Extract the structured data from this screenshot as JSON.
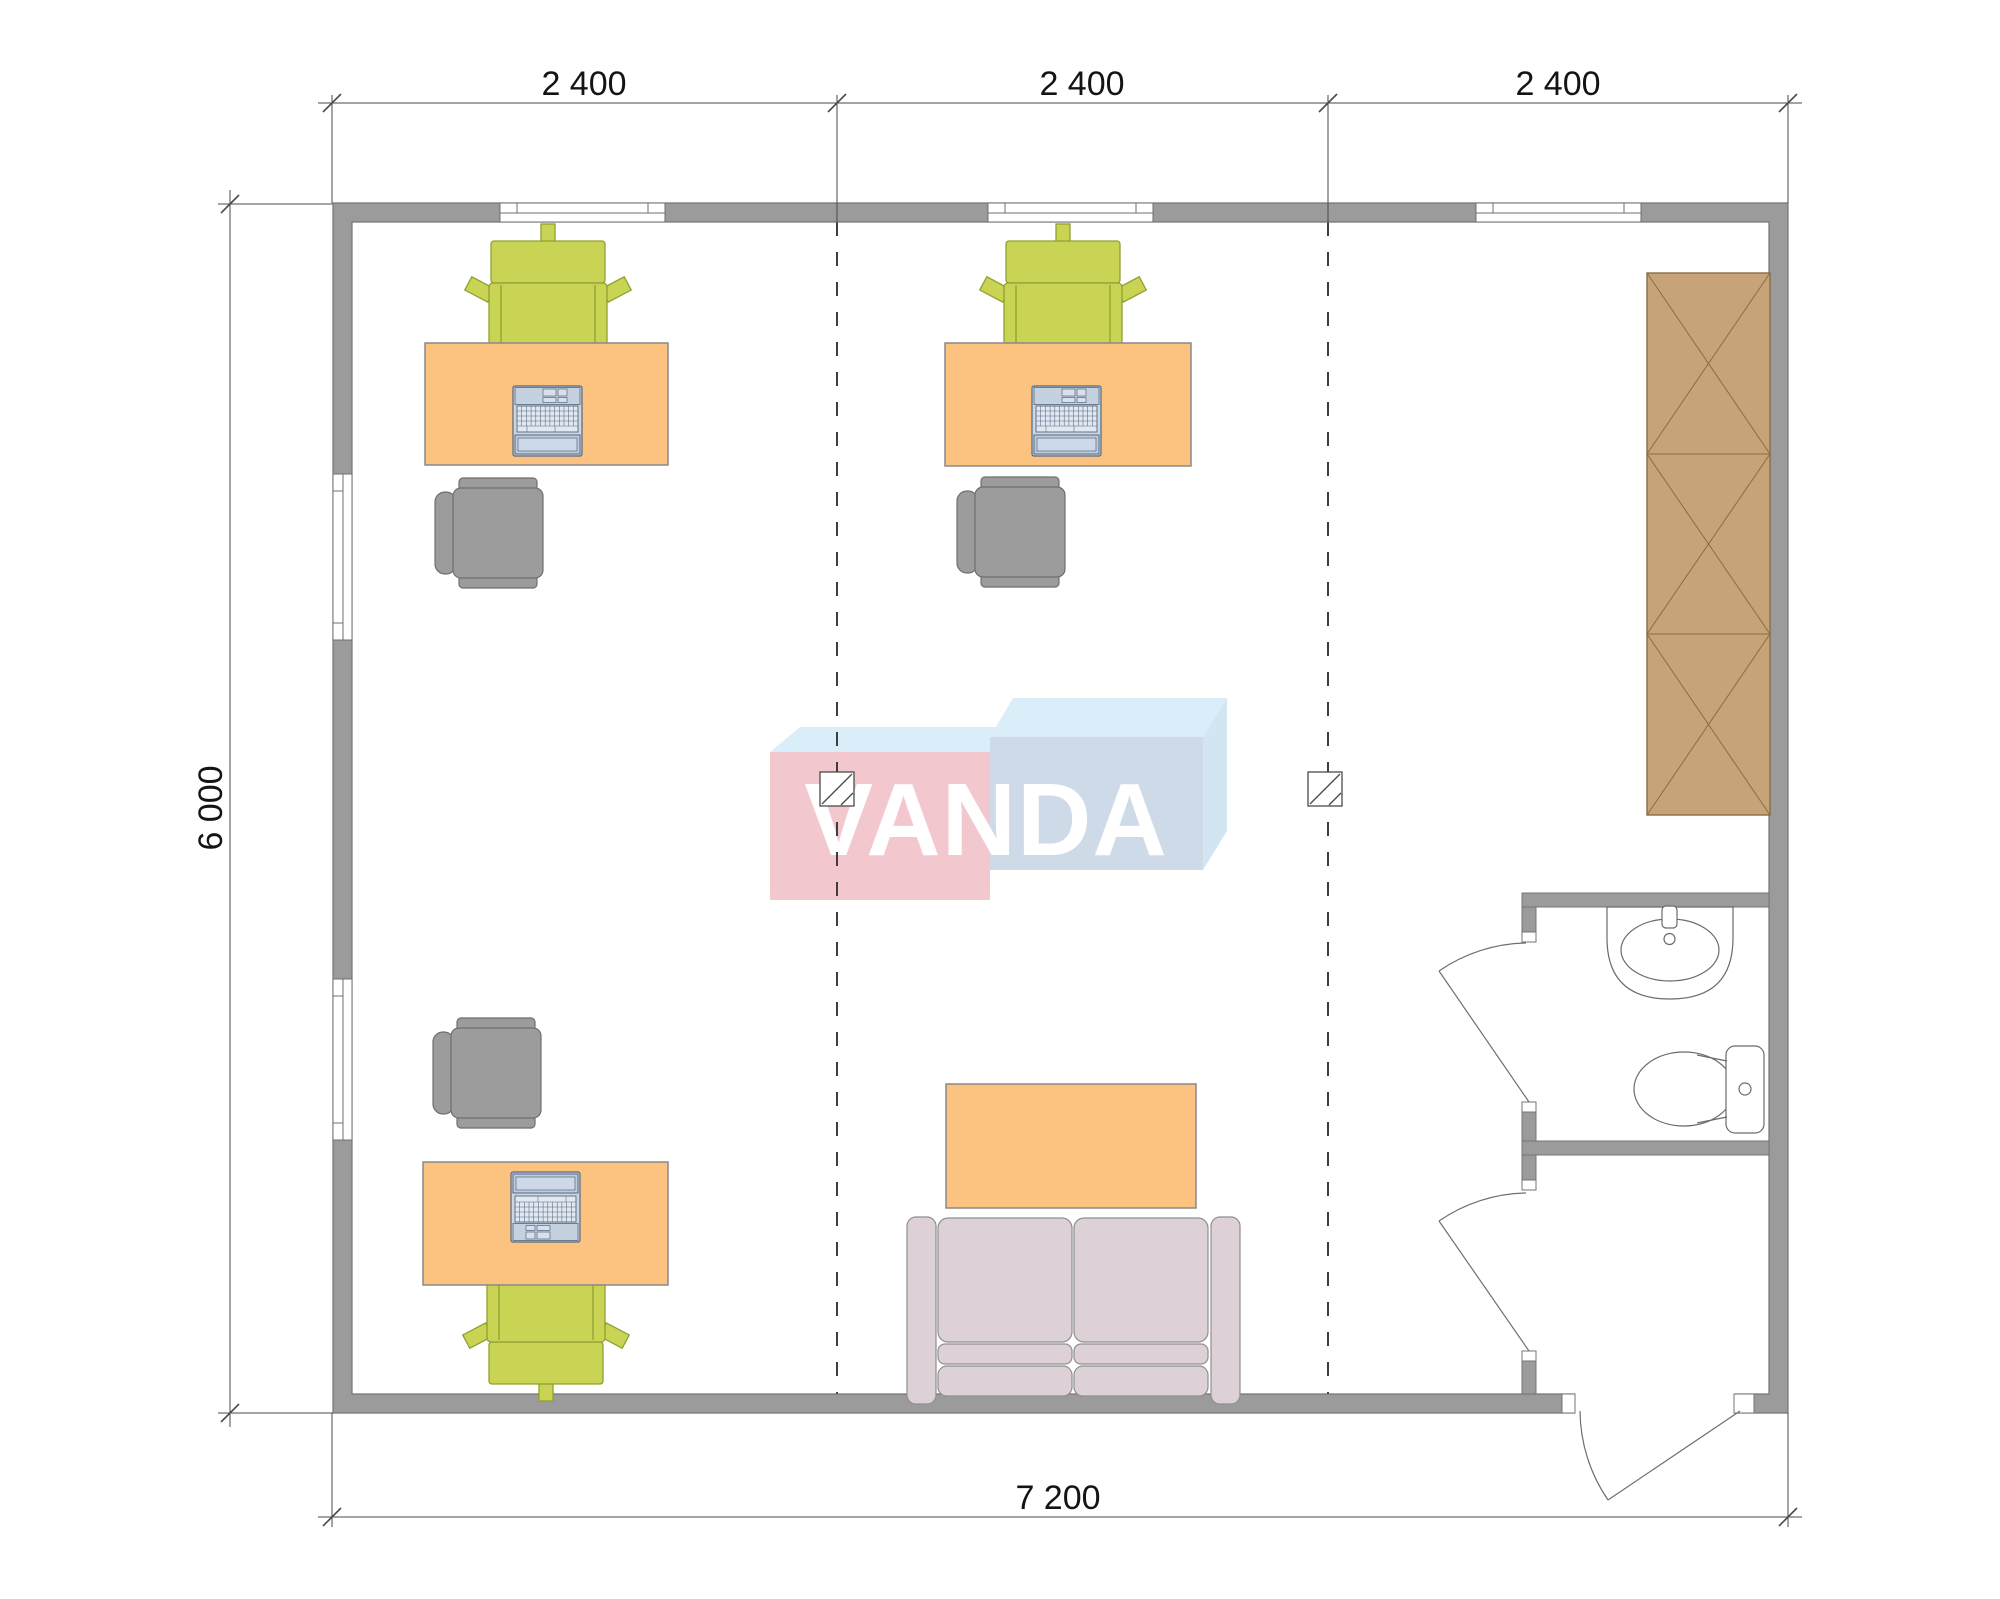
{
  "drawing": {
    "type": "office floor plan",
    "symbols": [
      "window",
      "door-swing",
      "axis-line",
      "column-marker",
      "desk",
      "task-chair",
      "visitor-chair",
      "laptop",
      "sofa",
      "coffee-table",
      "wardrobe",
      "sink",
      "toilet"
    ]
  },
  "dimensions": {
    "top_segments": [
      "2 400",
      "2 400",
      "2 400"
    ],
    "left_total": "6 000",
    "bottom_total": "7 200"
  },
  "watermark": {
    "text": "VANDA",
    "front_left_color": "#f2c6cc",
    "front_right_color": "#ccd9e7",
    "top_face_color": "#d8eef8",
    "side_face_color": "#cfe4f2",
    "letter_color": "#ffffff"
  },
  "colors": {
    "wall": "#9b9b9b",
    "wall_edge": "#757575",
    "desk": "#fcc280",
    "chair_task": "#c9d455",
    "chair_visitor": "#9c9c9c",
    "sofa": "#ddd0d6",
    "wardrobe": "#c7a478",
    "laptop_body": "#cdd7e4",
    "fixture_line": "#6b6b6b",
    "dimension_line": "#4a4a4a",
    "axis_line": "#3d3d3d"
  }
}
